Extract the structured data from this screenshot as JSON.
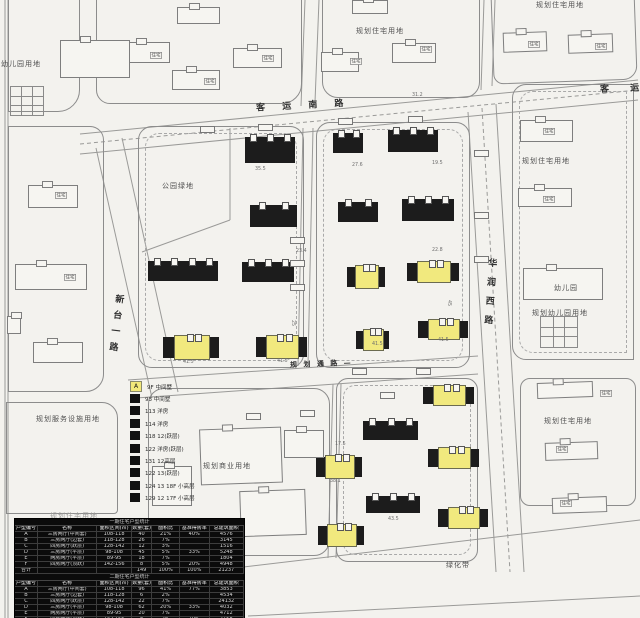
{
  "canvas": {
    "width": 640,
    "height": 618,
    "paper_color": "#f3f2ee",
    "line_color": "#8c8c8c",
    "building_color": "#1c1c1c",
    "highlight_color": "#f1e97e"
  },
  "road_labels": [
    {
      "text": "客 运 南 路",
      "x": 256,
      "y": 98,
      "rot": -3,
      "ls": 7,
      "vertical": false
    },
    {
      "text": "客  运",
      "x": 600,
      "y": 81,
      "rot": -2,
      "ls": 9,
      "vertical": false
    },
    {
      "text": "华润西路",
      "x": 483,
      "y": 258,
      "rot": 4,
      "ls": 10,
      "vertical": true
    },
    {
      "text": "新台一路",
      "x": 109,
      "y": 294,
      "rot": 7,
      "ls": 7,
      "vertical": true
    },
    {
      "text": "规 划 通 路 —",
      "x": 290,
      "y": 359,
      "rot": -2,
      "ls": 2,
      "vertical": false,
      "small": true
    }
  ],
  "land_labels": [
    {
      "text": "幼儿园用地",
      "x": 1,
      "y": 59
    },
    {
      "text": "规划住宅用地",
      "x": 356,
      "y": 26
    },
    {
      "text": "规划住宅用地",
      "x": 536,
      "y": 0
    },
    {
      "text": "公园绿地",
      "x": 162,
      "y": 181
    },
    {
      "text": "规划住宅用地",
      "x": 522,
      "y": 156
    },
    {
      "text": "幼儿园",
      "x": 554,
      "y": 283
    },
    {
      "text": "规划幼儿园用地",
      "x": 532,
      "y": 308
    },
    {
      "text": "规划服务设施用地",
      "x": 36,
      "y": 414
    },
    {
      "text": "规划商业用地",
      "x": 203,
      "y": 461
    },
    {
      "text": "规划住宅用地",
      "x": 544,
      "y": 416
    },
    {
      "text": "绿化带",
      "x": 446,
      "y": 560
    },
    {
      "text": "规划住宅用地",
      "x": 50,
      "y": 511,
      "muted": true
    }
  ],
  "legend": {
    "items": [
      {
        "marker": "yellow",
        "code": "A",
        "text": "9F 中间墅"
      },
      {
        "marker": "black",
        "code": "",
        "text": "93 中间墅"
      },
      {
        "marker": "black",
        "code": "",
        "text": "113 洋房"
      },
      {
        "marker": "black",
        "code": "",
        "text": "114 洋房"
      },
      {
        "marker": "black",
        "code": "",
        "text": "118 12(跃层)"
      },
      {
        "marker": "black",
        "code": "",
        "text": "122 洋房(跃层)"
      },
      {
        "marker": "black",
        "code": "",
        "text": "131 12高层"
      },
      {
        "marker": "black",
        "code": "",
        "text": "122 13(跃层)"
      },
      {
        "marker": "black",
        "code": "",
        "text": "124 13 18F 小高层"
      },
      {
        "marker": "black",
        "code": "",
        "text": "129 12 17F 小高层"
      }
    ]
  },
  "tables": {
    "col_widths": [
      10,
      26,
      15,
      9,
      12,
      13,
      15
    ],
    "headers": [
      "户型编号",
      "名称",
      "面积区间(㎡)",
      "数量(套)",
      "面积比",
      "基准得房率",
      "总建筑面积"
    ],
    "sections": [
      {
        "title": "一期住宅户型统计",
        "rows": [
          [
            "A",
            "三房两厅(中间套)",
            "108-118",
            "40",
            "21%",
            "40%",
            "4576"
          ],
          [
            "B",
            "三房两厅(边套)",
            "118-128",
            "26",
            "7%",
            "",
            "3145"
          ],
          [
            "C",
            "四房两厅(跃层)",
            "128-142",
            "12",
            "3%",
            "",
            "1516"
          ],
          [
            "D",
            "三房两厅(平层)",
            "98-108",
            "45",
            "5%",
            "33%",
            "5248"
          ],
          [
            "E",
            "两房两厅(平层)",
            "89-95",
            "18",
            "7%",
            "",
            "1804"
          ],
          [
            "F",
            "四房两厅(顶跃)",
            "142-156",
            "8",
            "5%",
            "20%",
            "4948"
          ]
        ],
        "total": [
          "合计",
          "",
          "",
          "149",
          "100%",
          "100%",
          "21237"
        ]
      },
      {
        "title": "二期住宅户型统计",
        "rows": [
          [
            "A",
            "三房两厅(中间套)",
            "108-118",
            "96",
            "41%",
            "77%",
            "3853"
          ],
          [
            "B",
            "三房两厅(边套)",
            "118-128",
            "6",
            "2%",
            "",
            "4534"
          ],
          [
            "C",
            "四房两厅(跃层)",
            "128-142",
            "22",
            "7%",
            "",
            "24132"
          ],
          [
            "D",
            "三房两厅(平层)",
            "98-108",
            "62",
            "20%",
            "33%",
            "4032"
          ],
          [
            "E",
            "两房两厅(平层)",
            "89-95",
            "20",
            "7%",
            "",
            "4712"
          ],
          [
            "F",
            "四房两厅(顶跃)",
            "142-156",
            "8",
            "2%",
            "10%",
            "7158"
          ],
          [
            "G",
            "叠拼(上叠)",
            "160-175",
            "12",
            "4%",
            "",
            "7142"
          ]
        ],
        "total": [
          "合计",
          "",
          "",
          "226",
          "100%",
          "200%",
          "54852"
        ]
      }
    ],
    "footer_title": "三期住宅户型统计"
  },
  "annotations": {
    "dims": [
      [
        255,
        166,
        "35.5",
        0
      ],
      [
        352,
        162,
        "27.6",
        0
      ],
      [
        432,
        160,
        "19.5",
        0
      ],
      [
        296,
        248,
        "23.4",
        0
      ],
      [
        432,
        247,
        "22.8",
        0
      ],
      [
        183,
        359,
        "41.5",
        0
      ],
      [
        277,
        358,
        "41.5",
        0
      ],
      [
        372,
        341,
        "41.5",
        0
      ],
      [
        438,
        337,
        "41.5",
        0
      ],
      [
        330,
        478,
        "38.1",
        0
      ],
      [
        388,
        516,
        "43.5",
        0
      ],
      [
        335,
        441,
        "17.5",
        0
      ],
      [
        412,
        92,
        "31.2",
        0
      ],
      [
        452,
        300,
        "45",
        90
      ],
      [
        296,
        320,
        "25",
        90
      ]
    ],
    "tags": [
      [
        150,
        52,
        "住宅"
      ],
      [
        204,
        78,
        "住宅"
      ],
      [
        262,
        55,
        "住宅"
      ],
      [
        350,
        58,
        "住宅"
      ],
      [
        420,
        46,
        "住宅"
      ],
      [
        528,
        41,
        "住宅"
      ],
      [
        595,
        43,
        "住宅"
      ],
      [
        543,
        128,
        "住宅"
      ],
      [
        543,
        196,
        "住宅"
      ],
      [
        55,
        192,
        "住宅"
      ],
      [
        64,
        274,
        "住宅"
      ],
      [
        600,
        390,
        "住宅"
      ],
      [
        556,
        446,
        "住宅"
      ],
      [
        560,
        500,
        "住宅"
      ]
    ],
    "chips": [
      [
        290,
        237
      ],
      [
        290,
        260
      ],
      [
        290,
        284
      ],
      [
        474,
        150
      ],
      [
        474,
        212
      ],
      [
        474,
        256
      ],
      [
        352,
        368
      ],
      [
        416,
        368
      ],
      [
        200,
        126
      ],
      [
        258,
        124
      ],
      [
        338,
        118
      ],
      [
        408,
        116
      ],
      [
        246,
        413
      ],
      [
        380,
        392
      ],
      [
        300,
        410
      ]
    ]
  },
  "geometry": {
    "lines": [
      [
        5,
        0,
        5,
        618,
        "s"
      ],
      [
        8,
        0,
        8,
        618,
        "s"
      ],
      [
        80,
        134,
        638,
        80,
        "s"
      ],
      [
        80,
        154,
        638,
        100,
        "s"
      ],
      [
        80,
        144,
        638,
        90,
        "d"
      ],
      [
        96,
        148,
        152,
        398,
        "s"
      ],
      [
        122,
        138,
        178,
        392,
        "s"
      ],
      [
        468,
        112,
        496,
        572,
        "s"
      ],
      [
        496,
        104,
        524,
        572,
        "s"
      ],
      [
        482,
        108,
        510,
        572,
        "d"
      ],
      [
        128,
        380,
        478,
        356,
        "s"
      ],
      [
        136,
        398,
        478,
        374,
        "s"
      ],
      [
        303,
        128,
        298,
        366,
        "s"
      ],
      [
        313,
        128,
        308,
        366,
        "s"
      ],
      [
        305,
        0,
        301,
        106,
        "s"
      ],
      [
        319,
        0,
        315,
        102,
        "s"
      ],
      [
        484,
        0,
        481,
        90,
        "s"
      ],
      [
        495,
        0,
        492,
        86,
        "s"
      ],
      [
        333,
        384,
        328,
        558,
        "s"
      ],
      [
        341,
        384,
        336,
        558,
        "s"
      ],
      [
        235,
        568,
        640,
        520,
        "s"
      ],
      [
        248,
        616,
        640,
        596,
        "s"
      ],
      [
        230,
        128,
        230,
        220,
        "s"
      ],
      [
        230,
        220,
        142,
        252,
        "s"
      ]
    ],
    "parcels": [
      {
        "x": 8,
        "y": -6,
        "w": 72,
        "h": 118,
        "r": "0 0 22px 0"
      },
      {
        "x": 96,
        "y": -8,
        "w": 206,
        "h": 112,
        "r": "0 0 20px 14px"
      },
      {
        "x": 322,
        "y": -8,
        "w": 158,
        "h": 106,
        "r": "0 0 16px 16px"
      },
      {
        "x": 492,
        "y": -12,
        "w": 144,
        "h": 94,
        "r": "0 0 14px 10px",
        "rot": -2
      },
      {
        "x": 8,
        "y": 126,
        "w": 96,
        "h": 266,
        "r": "0 14px 18px 0"
      },
      {
        "x": 6,
        "y": 402,
        "w": 112,
        "h": 112,
        "r": "0 16px 4px 0"
      },
      {
        "x": 138,
        "y": 126,
        "w": 166,
        "h": 242,
        "r": "14px",
        "dash": true
      },
      {
        "x": 316,
        "y": 122,
        "w": 154,
        "h": 246,
        "r": "14px",
        "dash": true
      },
      {
        "x": 148,
        "y": 388,
        "w": 182,
        "h": 168,
        "r": "16px"
      },
      {
        "x": 336,
        "y": 378,
        "w": 142,
        "h": 184,
        "r": "12px",
        "dash": true
      },
      {
        "x": 512,
        "y": 84,
        "w": 122,
        "h": 276,
        "r": "14px 0 0 14px",
        "dash": true
      },
      {
        "x": 520,
        "y": 378,
        "w": 116,
        "h": 128,
        "r": "10px"
      }
    ],
    "solid_buildings": [
      [
        245,
        137,
        50,
        26
      ],
      [
        333,
        133,
        30,
        20
      ],
      [
        388,
        130,
        50,
        22
      ],
      [
        250,
        205,
        47,
        22
      ],
      [
        338,
        202,
        40,
        20
      ],
      [
        402,
        199,
        52,
        22
      ],
      [
        148,
        261,
        70,
        20
      ],
      [
        242,
        262,
        52,
        20
      ],
      [
        363,
        421,
        55,
        19
      ],
      [
        366,
        496,
        54,
        17
      ]
    ],
    "mixed_buildings": [
      [
        163,
        337,
        56,
        21
      ],
      [
        256,
        337,
        51,
        20
      ],
      [
        347,
        267,
        38,
        20
      ],
      [
        407,
        263,
        52,
        18
      ],
      [
        356,
        331,
        33,
        18
      ],
      [
        418,
        321,
        50,
        17
      ],
      [
        423,
        387,
        51,
        17
      ],
      [
        428,
        449,
        51,
        18
      ],
      [
        438,
        509,
        50,
        18
      ],
      [
        316,
        457,
        46,
        20
      ],
      [
        318,
        526,
        46,
        19
      ]
    ],
    "outline_buildings": [
      [
        122,
        42,
        48,
        21,
        0
      ],
      [
        172,
        70,
        48,
        20,
        0
      ],
      [
        233,
        48,
        49,
        20,
        0
      ],
      [
        177,
        7,
        43,
        17,
        0
      ],
      [
        352,
        0,
        36,
        14,
        0
      ],
      [
        321,
        52,
        38,
        20,
        0
      ],
      [
        392,
        43,
        44,
        20,
        0
      ],
      [
        503,
        32,
        44,
        20,
        -2
      ],
      [
        568,
        34,
        45,
        19,
        -2
      ],
      [
        520,
        120,
        53,
        22,
        0
      ],
      [
        518,
        188,
        54,
        19,
        0
      ],
      [
        523,
        268,
        80,
        32,
        0
      ],
      [
        28,
        185,
        50,
        23,
        0
      ],
      [
        15,
        264,
        72,
        26,
        0
      ],
      [
        33,
        342,
        50,
        21,
        0
      ],
      [
        7,
        316,
        14,
        18,
        0
      ],
      [
        537,
        382,
        56,
        16,
        -2
      ],
      [
        545,
        442,
        53,
        18,
        -2
      ],
      [
        552,
        497,
        55,
        16,
        -2
      ],
      [
        60,
        40,
        70,
        38,
        0
      ],
      [
        200,
        428,
        82,
        56,
        -2
      ],
      [
        240,
        490,
        66,
        46,
        -2
      ],
      [
        152,
        466,
        40,
        40,
        0
      ],
      [
        284,
        430,
        40,
        28,
        0
      ]
    ],
    "grids": [
      [
        10,
        86,
        32,
        28
      ],
      [
        540,
        316,
        36,
        30
      ]
    ]
  }
}
